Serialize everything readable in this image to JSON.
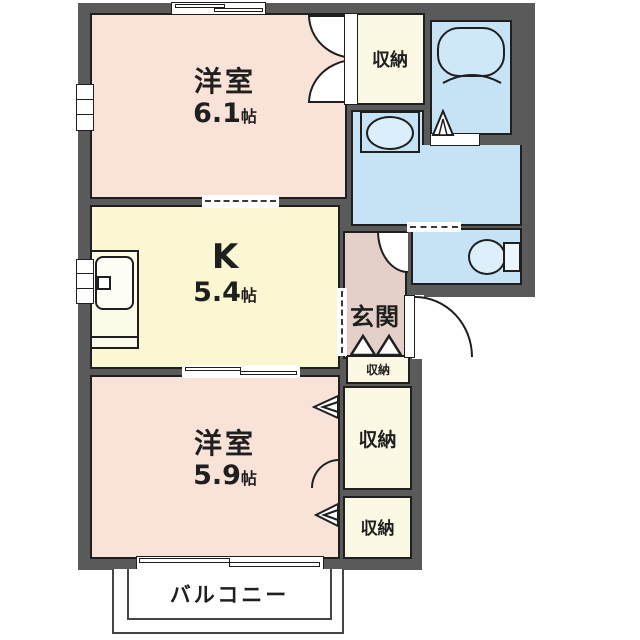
{
  "title": "1K apartment floor plan",
  "colors": {
    "wall": "#5a5a5a",
    "bedroom_pink": "#f9e3d8",
    "kitchen_yellow": "#faf7d2",
    "closet_cream": "#fbf8e3",
    "water_blue": "#c6e3f5",
    "entrance_mauve": "#e4cfc9",
    "line": "#1f1f1f"
  },
  "rooms": {
    "bedroom_top": {
      "name": "洋室",
      "size_num": "6.1",
      "size_unit": "帖"
    },
    "kitchen": {
      "name": "K",
      "size_num": "5.4",
      "size_unit": "帖"
    },
    "bedroom_bottom": {
      "name": "洋室",
      "size_num": "5.9",
      "size_unit": "帖"
    },
    "closet_top": {
      "label": "収納"
    },
    "closet_mid": {
      "label": "収納"
    },
    "closet_bottom": {
      "label": "収納"
    },
    "closet_entrance": {
      "label": "収納"
    },
    "entrance": {
      "label": "玄関"
    },
    "balcony": {
      "label": "バルコニー"
    }
  }
}
